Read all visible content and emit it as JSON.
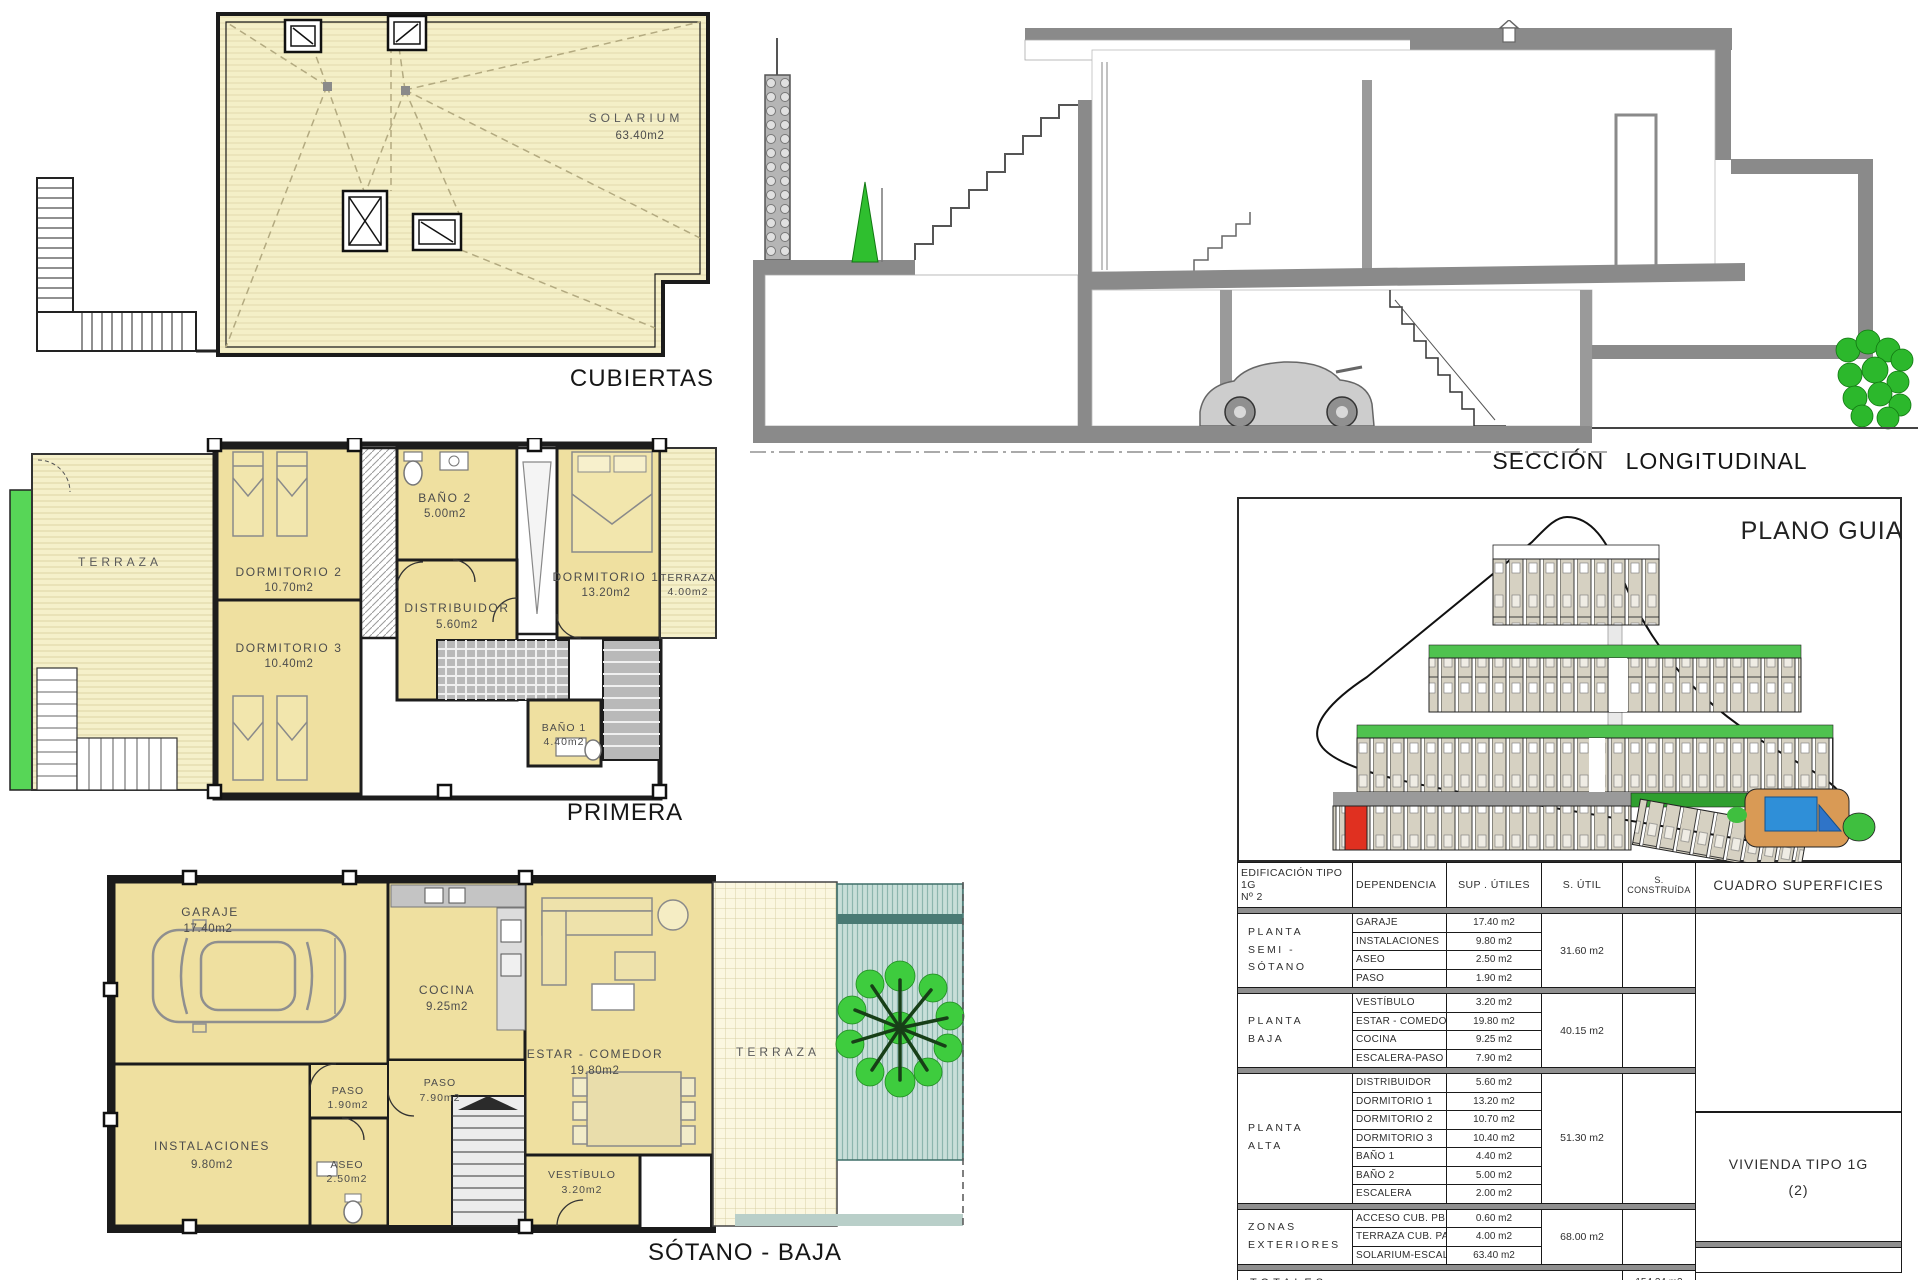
{
  "drawings": {
    "cubiertas": {
      "label": "CUBIERTAS",
      "solarium_name": "SOLARIUM",
      "solarium_area": "63.40m2"
    },
    "seccion": {
      "label": "SECCIÓN  LONGITUDINAL"
    },
    "primera": {
      "label": "PRIMERA",
      "terraza_left": "TERRAZA",
      "dormitorio2_name": "DORMITORIO 2",
      "dormitorio2_area": "10.70m2",
      "dormitorio3_name": "DORMITORIO 3",
      "dormitorio3_area": "10.40m2",
      "bano2_name": "BAÑO 2",
      "bano2_area": "5.00m2",
      "distribuidor_name": "DISTRIBUIDOR",
      "distribuidor_area": "5.60m2",
      "dormitorio1_name": "DORMITORIO 1",
      "dormitorio1_area": "13.20m2",
      "terraza_right_name": "TERRAZA",
      "terraza_right_area": "4.00m2",
      "bano1_name": "BAÑO 1",
      "bano1_area": "4.40m2"
    },
    "sotano": {
      "label": "SÓTANO -  BAJA",
      "garaje_name": "GARAJE",
      "garaje_area": "17.40m2",
      "cocina_name": "COCINA",
      "cocina_area": "9.25m2",
      "estar_name": "ESTAR - COMEDOR",
      "estar_area": "19.80m2",
      "paso_small_name": "PASO",
      "paso_small_area": "1.90m2",
      "paso_big_name": "PASO",
      "paso_big_area": "7.90m2",
      "instalaciones_name": "INSTALACIONES",
      "instalaciones_area": "9.80m2",
      "aseo_name": "ASEO",
      "aseo_area": "2.50m2",
      "vestibulo_name": "VESTÍBULO",
      "vestibulo_area": "3.20m2",
      "terraza": "TERRAZA"
    },
    "plano_guia": {
      "title": "PLANO GUIA"
    }
  },
  "table": {
    "headers": {
      "edificacion": "EDIFICACIÓN TIPO 1G\nNº 2",
      "dependencia": "DEPENDENCIA",
      "sup_utiles": "SUP . ÚTILES",
      "s_util": "S. ÚTIL",
      "s_construida": "S. CONSTRUÍDA",
      "cuadro": "CUADRO SUPERFICIES"
    },
    "groups": [
      {
        "floor": "PLANTA\nSEMI - SÓTANO",
        "rows": [
          {
            "dep": "GARAJE",
            "sup": "17.40 m2"
          },
          {
            "dep": "INSTALACIONES",
            "sup": "9.80 m2"
          },
          {
            "dep": "ASEO",
            "sup": "2.50 m2"
          },
          {
            "dep": "PASO",
            "sup": "1.90 m2"
          }
        ],
        "subtotal": "31.60 m2"
      },
      {
        "floor": "PLANTA\nBAJA",
        "rows": [
          {
            "dep": "VESTÍBULO",
            "sup": "3.20 m2"
          },
          {
            "dep": "ESTAR - COMEDOR",
            "sup": "19.80 m2"
          },
          {
            "dep": "COCINA",
            "sup": "9.25 m2"
          },
          {
            "dep": "ESCALERA-PASO",
            "sup": "7.90 m2"
          }
        ],
        "subtotal": "40.15 m2"
      },
      {
        "floor": "PLANTA\nALTA",
        "rows": [
          {
            "dep": "DISTRIBUIDOR",
            "sup": "5.60 m2"
          },
          {
            "dep": "DORMITORIO 1",
            "sup": "13.20 m2"
          },
          {
            "dep": "DORMITORIO 2",
            "sup": "10.70 m2"
          },
          {
            "dep": "DORMITORIO 3",
            "sup": "10.40 m2"
          },
          {
            "dep": "BAÑO 1",
            "sup": "4.40 m2"
          },
          {
            "dep": "BAÑO 2",
            "sup": "5.00 m2"
          },
          {
            "dep": "ESCALERA",
            "sup": "2.00 m2"
          }
        ],
        "subtotal": "51.30 m2"
      },
      {
        "floor": "ZONAS\nEXTERIORES",
        "rows": [
          {
            "dep": "ACCESO CUB.  PB",
            "sup": "0.60 m2"
          },
          {
            "dep": "TERRAZA CUB.  PA",
            "sup": "4.00 m2"
          },
          {
            "dep": "SOLARIUM-ESCAL.",
            "sup": "63.40 m2"
          }
        ],
        "subtotal": "68.00 m2"
      }
    ],
    "totals_label": "TOTALES",
    "total_construida": "154.24 m2",
    "vivienda_line1": "VIVIENDA TIPO 1G",
    "vivienda_line2": "(2)"
  },
  "colors": {
    "room_fill": "#efe0a0",
    "roof_fill": "#f4efc7",
    "green_strip": "#57d657",
    "teal_garden": "#c8dfd9",
    "wall": "#1b1b1b",
    "section_grey": "#8a8a8a",
    "pool_blue": "#2f8fd8",
    "highlight_red": "#e03020",
    "site_green": "#4fc24f"
  }
}
